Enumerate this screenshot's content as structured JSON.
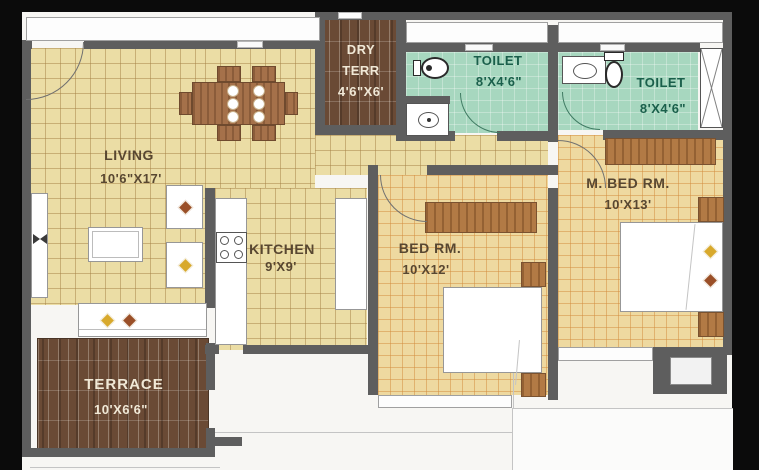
{
  "plan_title": "2 BHK apartment floor plan",
  "rooms": {
    "living": {
      "name": "LIVING",
      "dims": "10'6\"X17'"
    },
    "kitchen": {
      "name": "KITCHEN",
      "dims": "9'X9'"
    },
    "dry_terrace": {
      "line1": "DRY",
      "line2": "TERR",
      "dims": "4'6\"X6'"
    },
    "toilet_common": {
      "name": "TOILET",
      "dims": "8'X4'6\""
    },
    "toilet_master": {
      "name": "TOILET",
      "dims": "8'X4'6\""
    },
    "bedroom": {
      "name": "BED RM.",
      "dims": "10'X12'"
    },
    "master_bedroom": {
      "name": "M. BED RM.",
      "dims": "10'X13'"
    },
    "terrace": {
      "name": "TERRACE",
      "dims": "10'X6'6\""
    }
  },
  "colors": {
    "background": "#0b0b0b",
    "sheet": "#f7f6f3",
    "wall": "#5e5e5e",
    "floor_tile": "#ebdda5",
    "bedroom_tile": "#eed9a0",
    "toilet_floor": "#a7d7bf",
    "wood_deck": "#6a4a35",
    "furniture_wood": "#a5714a",
    "label_text": "#584731",
    "toilet_label_text": "#1a5f4b",
    "deck_label_text": "#f0e8d6",
    "cushion_gold": "#d8a92c",
    "cushion_rust": "#9a4f28"
  },
  "icons": [
    "stove-icon",
    "wc-icon",
    "washbasin-icon",
    "tv-icon",
    "duct-x-icon",
    "door-swing-arc",
    "dining-set"
  ]
}
